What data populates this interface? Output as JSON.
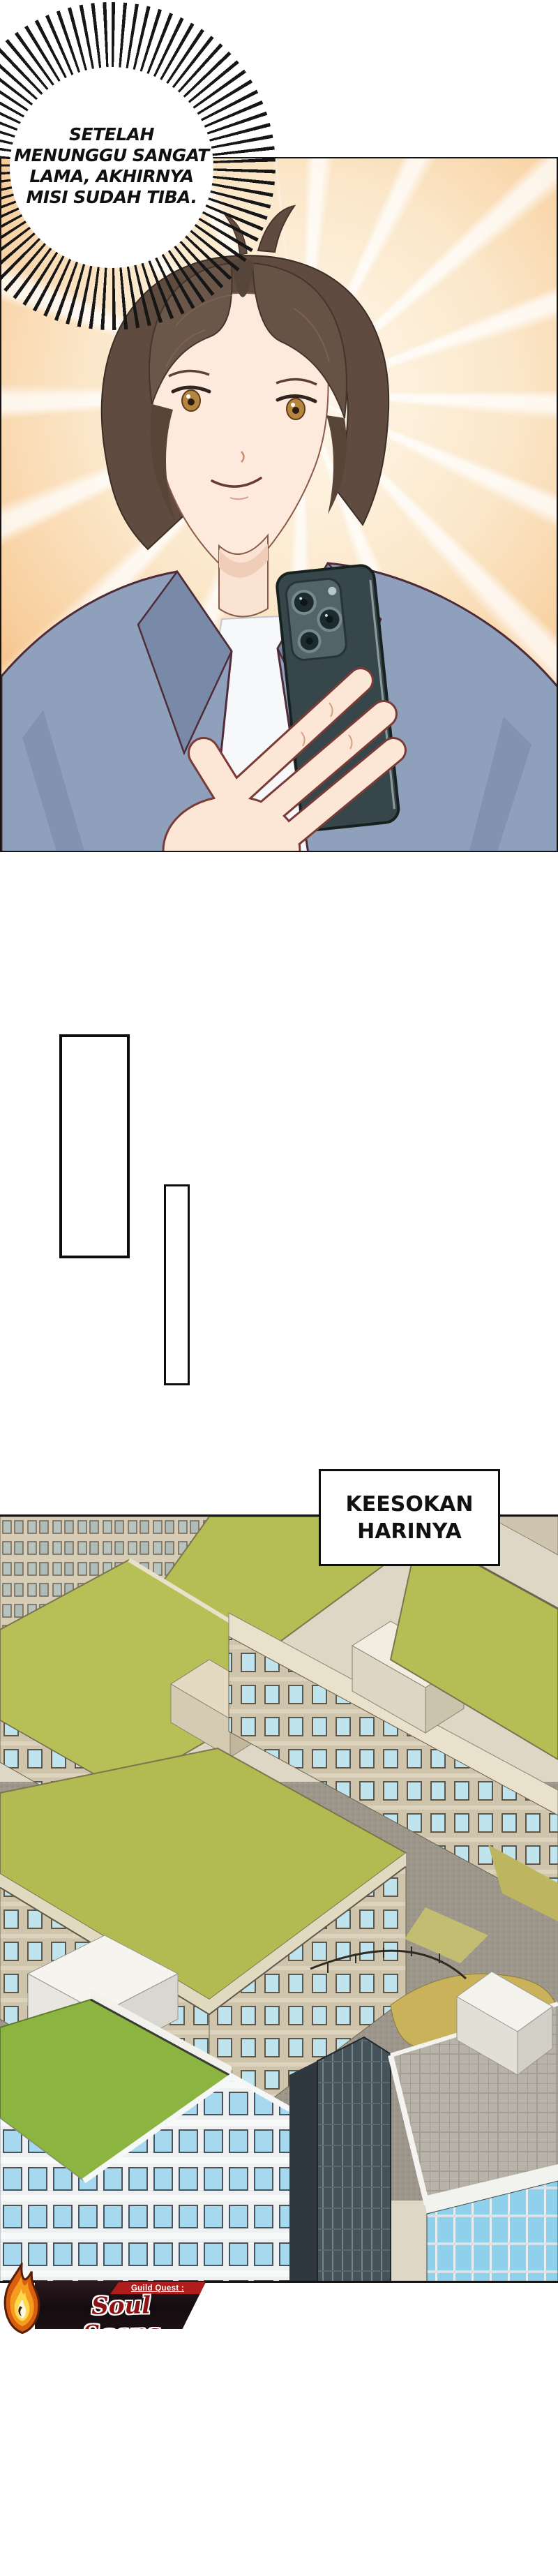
{
  "comic": {
    "speech_bubble": {
      "lines": [
        "SETELAH",
        "MENUNGGU SANGAT",
        "LAMA, AKHIRNYA",
        "MISI SUDAH TIBA."
      ]
    },
    "caption": {
      "lines": [
        "KEESOKAN",
        "HARINYA"
      ]
    },
    "footer": {
      "guild_label": "Guild Quest :",
      "group_name": "Soul Scans"
    },
    "colors": {
      "panel_border": "#141414",
      "sunburst_orange": "#f1a65f",
      "hair_brown": "#5f4b3f",
      "jacket_blue": "#8fa0bd",
      "phone_dark": "#37464a",
      "roof_green": "#b5be54",
      "bright_roof_green": "#8cb441",
      "facade_beige": "#cfc4ac",
      "courtyard_gray": "#9d978b",
      "banner_red": "#b01d1d",
      "logo_text_red": "#8c1214",
      "flame_orange": "#f59b1e"
    }
  }
}
